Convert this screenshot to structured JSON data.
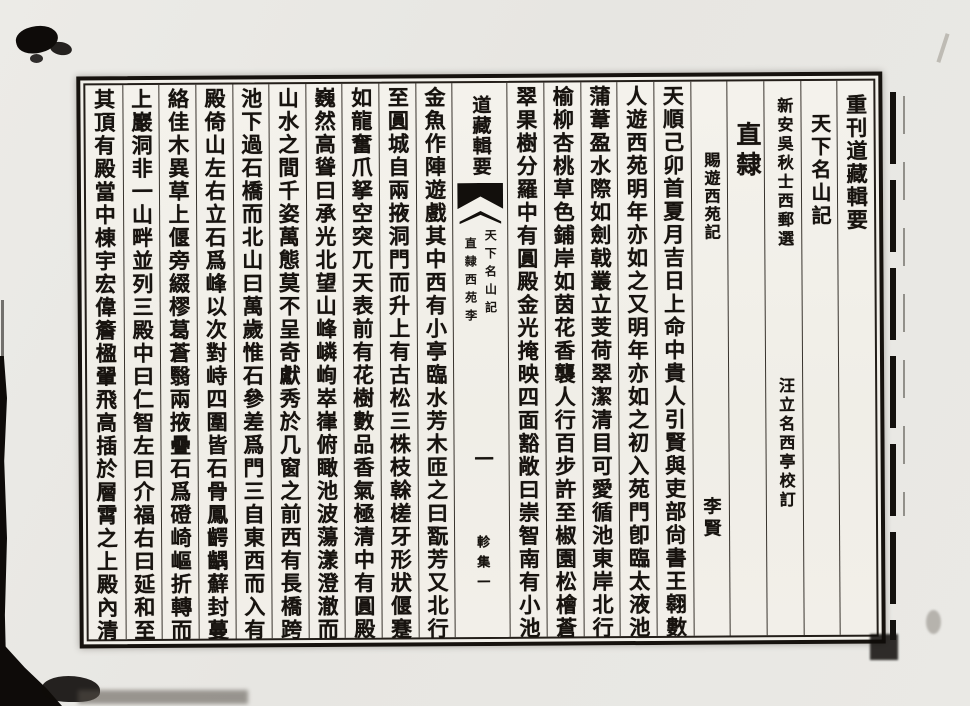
{
  "colors": {
    "ink": "#17130f",
    "paper": "#f2f0ea",
    "scan_background": "#e9e8e4",
    "border": "#16120e"
  },
  "page": {
    "series_title": "重刊道藏輯要",
    "work_title": "天下名山記",
    "compiler": "新安吳秋士西郵選",
    "collator": "汪立名西亭校訂",
    "region": "直隸",
    "piece_title": "賜遊西苑記",
    "author": "李賢"
  },
  "fold": {
    "banner": "道藏輯要",
    "small_right": "天下名山記",
    "small_left": "直隸西苑李",
    "folio": "一",
    "collection": "軫集一"
  },
  "body": {
    "right": [
      "天順己卯首夏月吉日上命中貴人引賢與吏部尙書王翱數",
      "人遊西苑明年亦如之又明年亦如之初入苑門卽臨太液池",
      "蒲葦盈水際如劍戟叢立芰荷翠潔清目可愛循池東岸北行",
      "榆柳杏桃草色鋪岸如茵花香襲人行百步許至椒園松檜蒼",
      "翠果樹分羅中有圓殿金光掩映四面豁敞曰崇智南有小池"
    ],
    "left": [
      "金魚作陣遊戲其中西有小亭臨水芳木匝之曰翫芳又北行",
      "至圓城自兩掖洞門而升上有古松三株枝榦槎牙形狀偃蹇",
      "如龍奮爪拏空突兀天表前有花樹數品香氣極清中有圓殿",
      "巍然高聳曰承光北望山峰嶙峋崒嵂俯瞰池波蕩漾澄澈而",
      "山水之間千姿萬態莫不呈奇獻秀於几窗之前西有長橋跨",
      "池下過石橋而北山曰萬歲惟石參差爲門三自東西而入有",
      "殿倚山左右立石爲峰以次對峙四圍皆石骨鳳齶齵蘚封蔓",
      "絡佳木異草上偃旁綴樛葛蒼翳兩掖疊石爲磴崎嶇折轉而",
      "上巖洞非一山畔並列三殿中曰仁智左曰介福右曰延和至",
      "其頂有殿當中棟宇宏偉簷楹翬飛高插於層霄之上殿內清"
    ]
  }
}
